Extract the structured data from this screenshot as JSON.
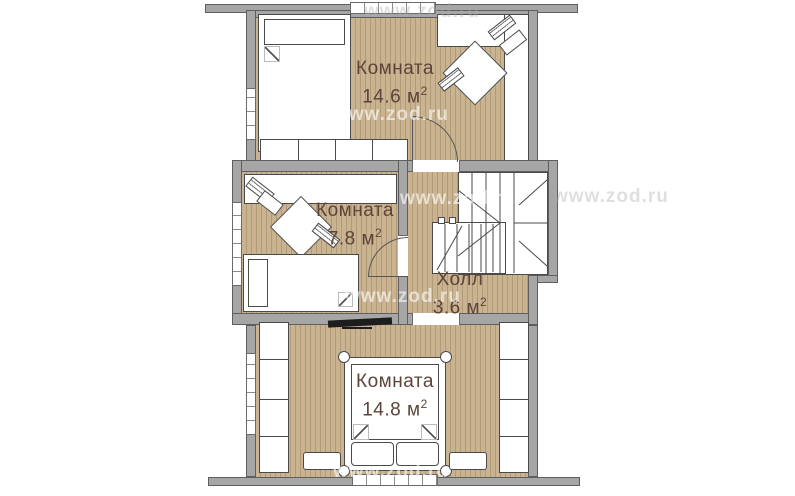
{
  "watermark": "www.zod.ru",
  "rooms": {
    "top": {
      "name": "Комната",
      "area": "14.6",
      "unit": "м",
      "sup": "2"
    },
    "left": {
      "name": "Комната",
      "area": "7.8",
      "unit": "м",
      "sup": "2"
    },
    "hall": {
      "name": "Холл",
      "area": "3.6",
      "unit": "м",
      "sup": "2"
    },
    "bottom": {
      "name": "Комната",
      "area": "14.8",
      "unit": "м",
      "sup": "2"
    }
  },
  "colors": {
    "wall": "#a6a6a6",
    "wall_line": "#5e5e5e",
    "floor": "#c9b390",
    "plank": "#b19b77",
    "furn_line": "#4a4a4a",
    "label": "#5d443a"
  }
}
